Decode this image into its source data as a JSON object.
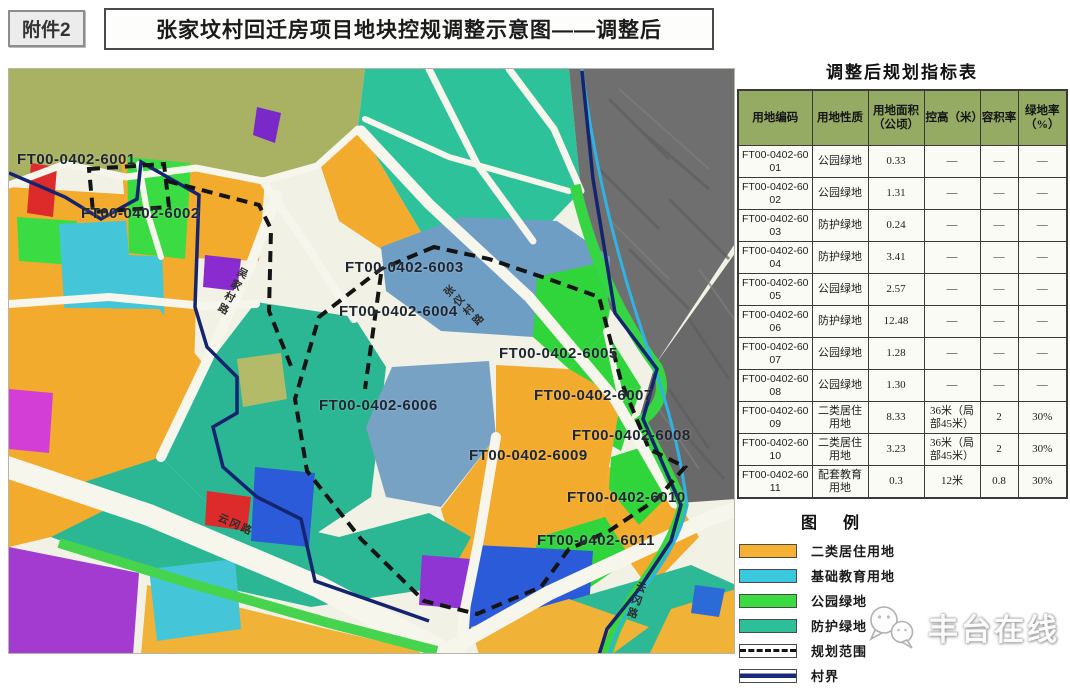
{
  "header": {
    "attachment": "附件2",
    "title": "张家坟村回迁房项目地块控规调整示意图——调整后"
  },
  "table": {
    "title": "调整后规划指标表",
    "columns": [
      "用地编码",
      "用地性质",
      "用地面积（公顷）",
      "控高（米）",
      "容积率",
      "绿地率（%）"
    ],
    "rows": [
      {
        "code": "FT00-0402-6001",
        "use": "公园绿地",
        "area": "0.33",
        "height": "—",
        "far": "—",
        "green": "—"
      },
      {
        "code": "FT00-0402-6002",
        "use": "公园绿地",
        "area": "1.31",
        "height": "—",
        "far": "—",
        "green": "—"
      },
      {
        "code": "FT00-0402-6003",
        "use": "防护绿地",
        "area": "0.24",
        "height": "—",
        "far": "—",
        "green": "—"
      },
      {
        "code": "FT00-0402-6004",
        "use": "防护绿地",
        "area": "3.41",
        "height": "—",
        "far": "—",
        "green": "—"
      },
      {
        "code": "FT00-0402-6005",
        "use": "公园绿地",
        "area": "2.57",
        "height": "—",
        "far": "—",
        "green": "—"
      },
      {
        "code": "FT00-0402-6006",
        "use": "防护绿地",
        "area": "12.48",
        "height": "—",
        "far": "—",
        "green": "—"
      },
      {
        "code": "FT00-0402-6007",
        "use": "公园绿地",
        "area": "1.28",
        "height": "—",
        "far": "—",
        "green": "—"
      },
      {
        "code": "FT00-0402-6008",
        "use": "公园绿地",
        "area": "1.30",
        "height": "—",
        "far": "—",
        "green": "—"
      },
      {
        "code": "FT00-0402-6009",
        "use": "二类居住用地",
        "area": "8.33",
        "height": "36米（局部45米）",
        "far": "2",
        "green": "30%"
      },
      {
        "code": "FT00-0402-6010",
        "use": "二类居住用地",
        "area": "3.23",
        "height": "36米（局部45米）",
        "far": "2",
        "green": "30%"
      },
      {
        "code": "FT00-0402-6011",
        "use": "配套教育用地",
        "area": "0.3",
        "height": "12米",
        "far": "0.8",
        "green": "30%"
      }
    ]
  },
  "legend": {
    "title": "图例",
    "items": [
      {
        "label": "二类居住用地",
        "style": "fill",
        "color": "#f5b232"
      },
      {
        "label": "基础教育用地",
        "style": "fill",
        "color": "#3cc8dc"
      },
      {
        "label": "公园绿地",
        "style": "fill",
        "color": "#3bdc43"
      },
      {
        "label": "防护绿地",
        "style": "fill",
        "color": "#2dbf97"
      },
      {
        "label": "规划范围",
        "style": "dashed",
        "color": "#141414"
      },
      {
        "label": "村界",
        "style": "line",
        "color": "#1b2a78"
      }
    ]
  },
  "map": {
    "plots": [
      {
        "code": "FT00-0402-6001",
        "x": 8,
        "y": 82
      },
      {
        "code": "FT00-0402-6002",
        "x": 72,
        "y": 136
      },
      {
        "code": "FT00-0402-6003",
        "x": 336,
        "y": 190
      },
      {
        "code": "FT00-0402-6004",
        "x": 330,
        "y": 234
      },
      {
        "code": "FT00-0402-6005",
        "x": 490,
        "y": 276
      },
      {
        "code": "FT00-0402-6006",
        "x": 310,
        "y": 328
      },
      {
        "code": "FT00-0402-6007",
        "x": 525,
        "y": 318
      },
      {
        "code": "FT00-0402-6008",
        "x": 563,
        "y": 358
      },
      {
        "code": "FT00-0402-6009",
        "x": 460,
        "y": 378
      },
      {
        "code": "FT00-0402-6010",
        "x": 558,
        "y": 420
      },
      {
        "code": "FT00-0402-6011",
        "x": 528,
        "y": 463
      }
    ],
    "roads": [
      {
        "name": "吴家村路",
        "x": 216,
        "y": 196,
        "rot": 28,
        "vertical": true
      },
      {
        "name": "张仪村路",
        "x": 448,
        "y": 210,
        "rot": -45,
        "vertical": true
      },
      {
        "name": "云冈路",
        "x": 208,
        "y": 448,
        "rot": 24,
        "vertical": false
      },
      {
        "name": "云冈路",
        "x": 620,
        "y": 512,
        "rot": 18,
        "vertical": true
      }
    ]
  },
  "watermark": {
    "text": "丰台在线"
  }
}
